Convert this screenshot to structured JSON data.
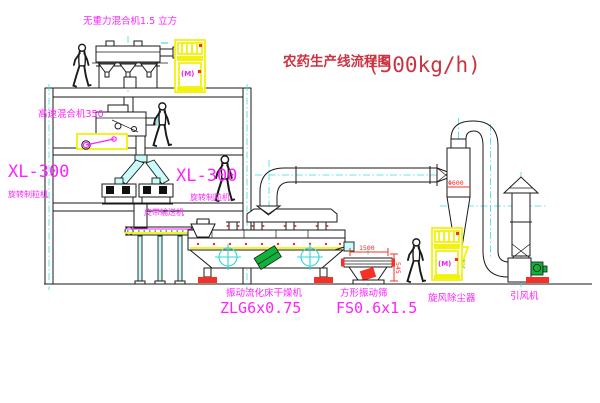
{
  "title": {
    "text": "农药生产线流程图",
    "capacity": "(500kg/h)"
  },
  "labels": {
    "gravity_mixer": "无重力混合机1.5 立方",
    "high_speed_mixer": "高速混合机350",
    "granulator_left_model": "XL-300",
    "granulator_left_name": "旋转制粒机",
    "granulator_right_model": "XL-300",
    "granulator_right_name": "旋转制粒机",
    "belt_conveyor": "皮带输送机",
    "dryer_name": "振动流化床干燥机",
    "dryer_model": "ZLG6x0.75",
    "sieve_name": "方形振动筛",
    "sieve_model": "FS0.6x1.5",
    "cyclone_name": "旋风除尘器",
    "fan_name": "引风机"
  },
  "dimensions": {
    "sieve_length": "1500",
    "sieve_height": "545",
    "cyclone_diameter": "Φ600"
  },
  "cabinet": {
    "symbol": "(M)"
  },
  "colors": {
    "line": "#1a1a1a",
    "magenta": "#ff22ff",
    "cyan": "#2fd8d8",
    "yellow": "#f2f20a",
    "red": "#f53127",
    "title_red": "#cc3340",
    "green": "#0fb33c",
    "background": "#ffffff"
  }
}
